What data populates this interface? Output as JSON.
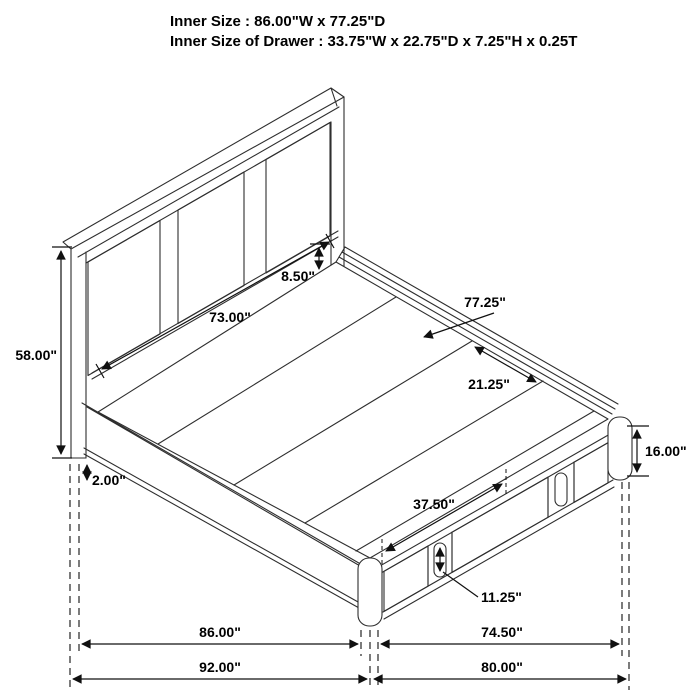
{
  "title": {
    "line1": "Inner Size : 86.00\"W x 77.25\"D",
    "line2": "Inner Size of Drawer : 33.75\"W x 22.75\"D x 7.25\"H x 0.25T"
  },
  "diagram": {
    "type": "isometric-bed-frame-dimension-drawing",
    "colors": {
      "line": "#2e2e2e",
      "dimension": "#101010",
      "flute": "#707070",
      "background": "#ffffff"
    },
    "dimensions": {
      "headboard_height": "58.00\"",
      "headboard_panel_width": "73.00\"",
      "headboard_rail_height": "8.50\"",
      "platform_depth": "77.25\"",
      "deck_plank_width": "21.25\"",
      "base_height": "16.00\"",
      "floor_clearance": "2.00\"",
      "drawer_front_width": "37.50\"",
      "drawer_front_height": "11.25\"",
      "platform_width": "86.00\"",
      "footboard_span": "74.50\"",
      "overall_width": "92.00\"",
      "overall_depth": "80.00\""
    }
  }
}
